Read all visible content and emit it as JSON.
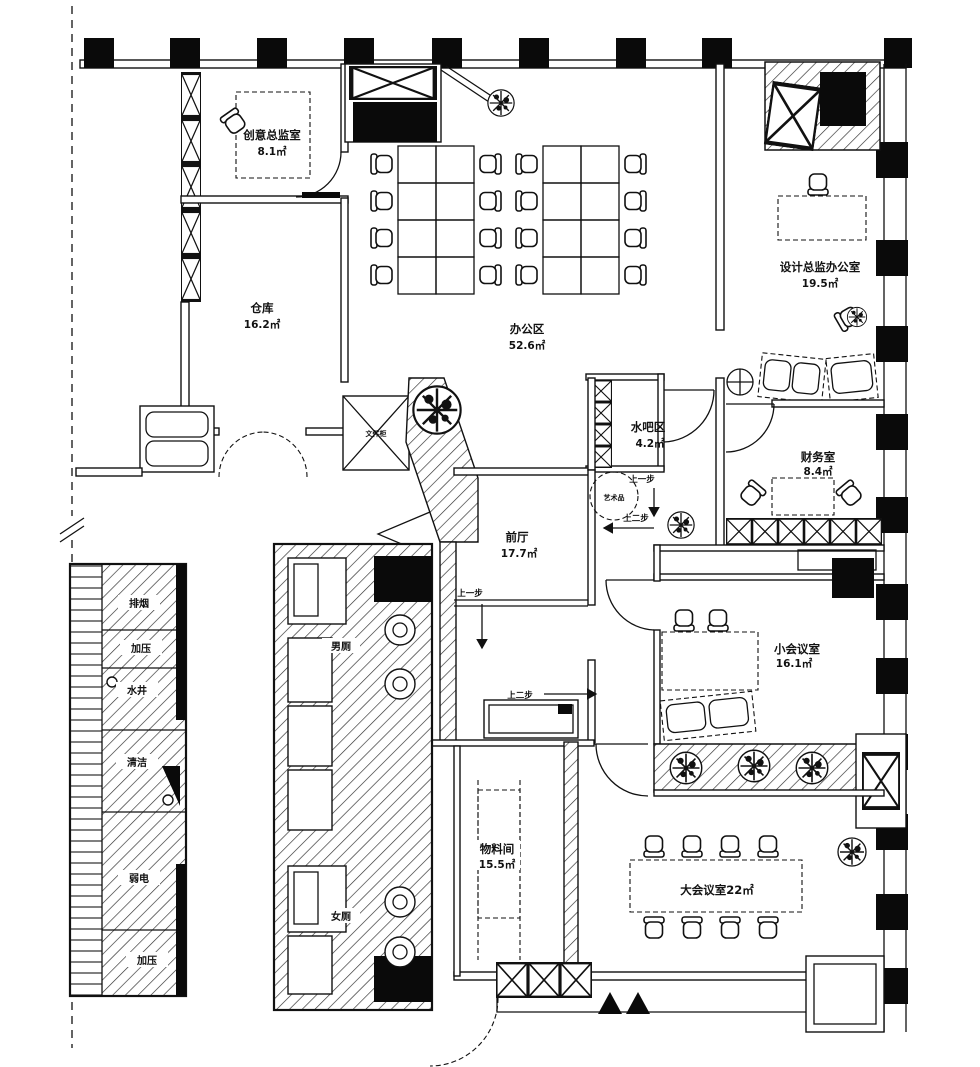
{
  "rooms": {
    "creative": {
      "name": "创意总监室",
      "area": "8.1㎡"
    },
    "warehouse": {
      "name": "仓库",
      "area": "16.2㎡"
    },
    "office": {
      "name": "办公区",
      "area": "52.6㎡"
    },
    "design": {
      "name": "设计总监办公室",
      "area": "19.5㎡"
    },
    "waterbar": {
      "name": "水吧区",
      "area": "4.2㎡"
    },
    "finance": {
      "name": "财务室",
      "area": "8.4㎡"
    },
    "foyer": {
      "name": "前厅",
      "area": "17.7㎡"
    },
    "small_meeting": {
      "name": "小会议室",
      "area": "16.1㎡"
    },
    "material": {
      "name": "物料间",
      "area": "15.5㎡"
    },
    "large_meeting": {
      "name": "大会议室",
      "area": "22㎡"
    },
    "mens": {
      "name": "男厕"
    },
    "womens": {
      "name": "女厕"
    }
  },
  "shafts": {
    "smoke_exhaust": "排烟",
    "pressurization_upper": "加压",
    "water_shaft": "水井",
    "cleaning": "清洁",
    "low_voltage": "弱电",
    "pressurization_lower": "加压"
  },
  "annotations": {
    "step_up_one": "上一步",
    "step_up_two": "上二步",
    "artwork": "艺术品",
    "cabinet": "文件柜"
  },
  "colors": {
    "ink": "#111111",
    "paper": "#ffffff"
  }
}
